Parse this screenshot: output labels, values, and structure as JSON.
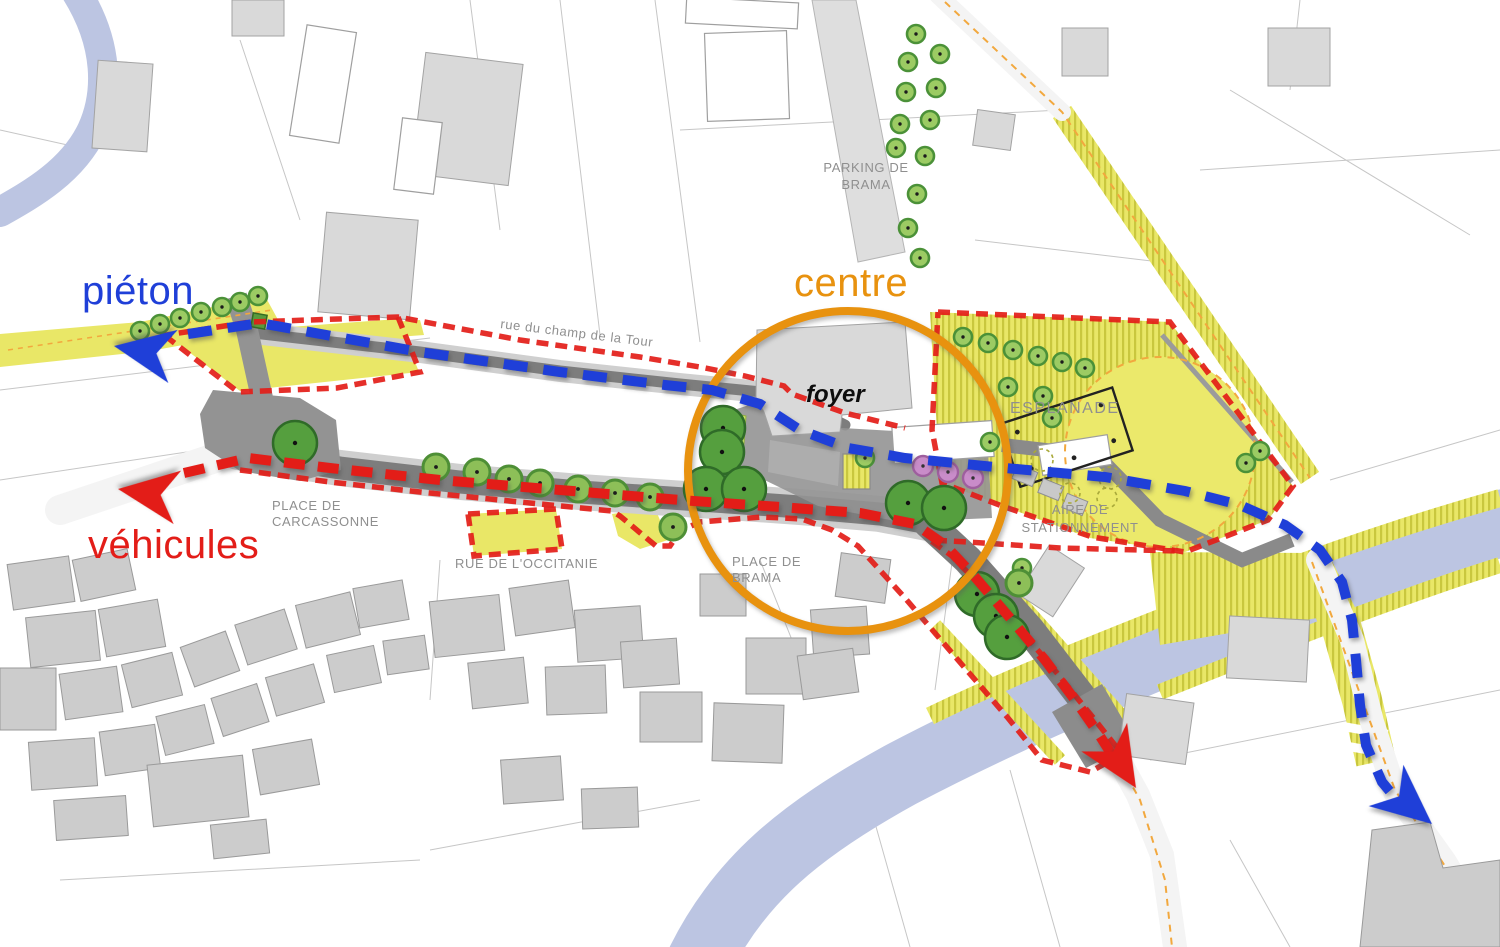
{
  "legend": {
    "pedestrian_label": "piéton",
    "vehicles_label": "véhicules",
    "centre_label": "centre"
  },
  "labels": {
    "street_tour": "rue du champ de la Tour",
    "parking_brama": [
      "PARKING DE",
      "BRAMA"
    ],
    "esplanade": "ESPLANADE",
    "aire_stationnement": [
      "AIRE DE",
      "STATIONNEMENT"
    ],
    "place_carcassonne": [
      "PLACE DE",
      "CARCASSONNE"
    ],
    "rue_occitanie": "RUE DE L'OCCITANIE",
    "place_brama": [
      "PLACE DE",
      "BRAMA"
    ],
    "foyer": "foyer"
  },
  "colors": {
    "blue": "#1f3fd8",
    "red": "#e31d18",
    "orange": "#e8920f",
    "yellow": "#e9e767",
    "water": "#bcc5e2",
    "road": "#7d7d7d",
    "labelgray": "#8f8f8f",
    "treelight": "#9ccb63",
    "treedark": "#4b9138",
    "treebig": "#559f3e",
    "treepink": "#c98cc9"
  }
}
